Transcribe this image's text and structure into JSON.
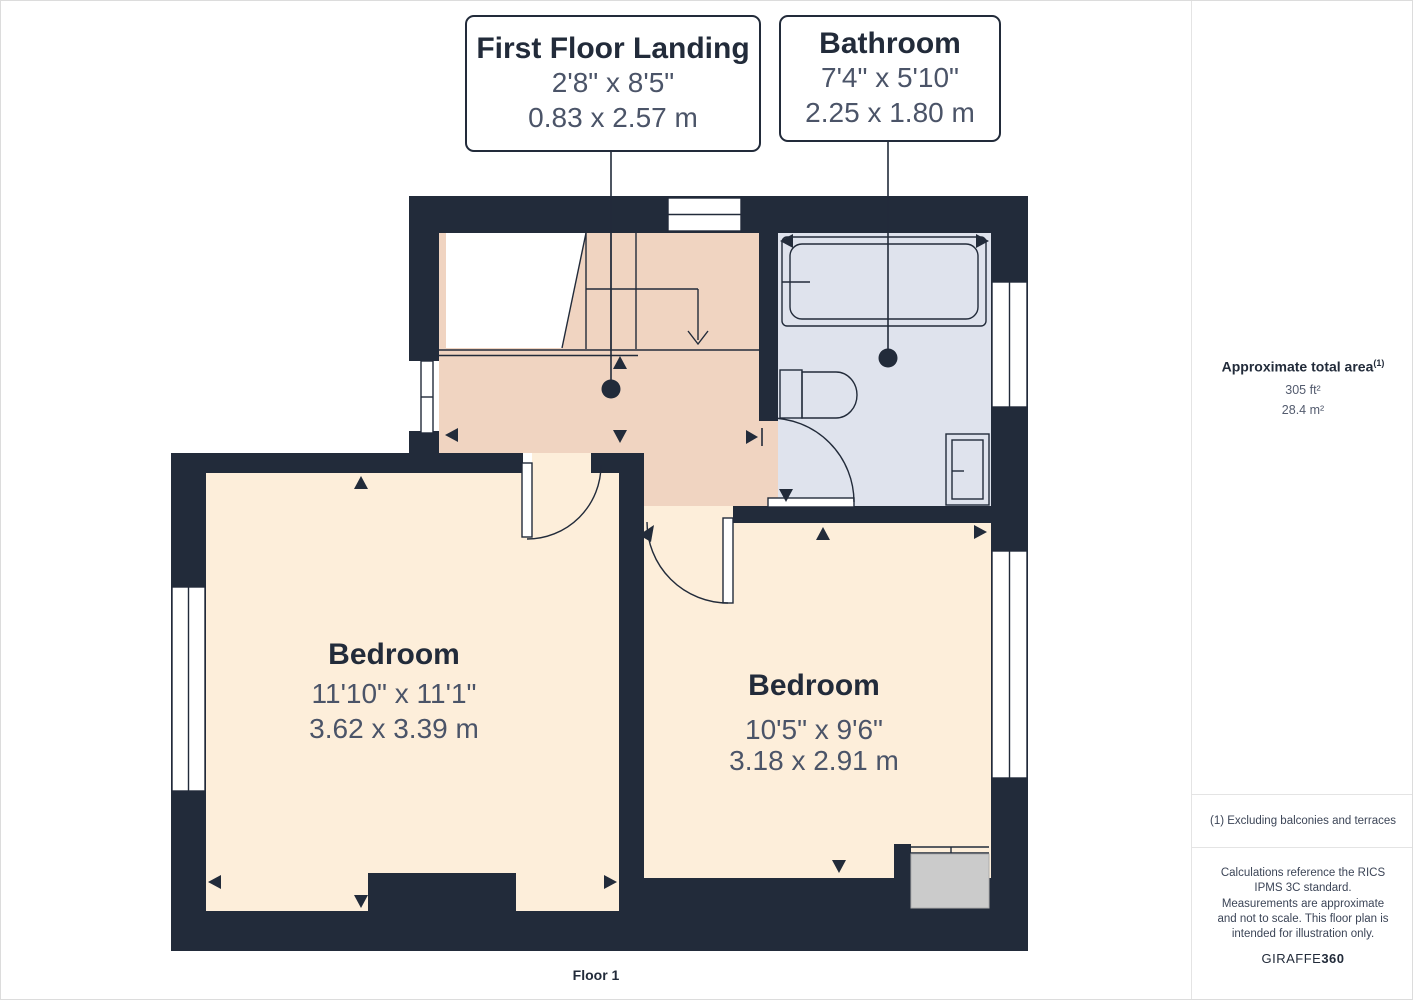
{
  "plan": {
    "floor_label": "Floor 1",
    "callouts": [
      {
        "title": "First Floor Landing",
        "imperial": "2'8\" x 8'5\"",
        "metric": "0.83 x 2.57 m"
      },
      {
        "title": "Bathroom",
        "imperial": "7'4\" x 5'10\"",
        "metric": "2.25 x 1.80 m"
      }
    ],
    "rooms": [
      {
        "name": "Bedroom",
        "imperial": "11'10\" x 11'1\"",
        "metric": "3.62 x 3.39 m"
      },
      {
        "name": "Bedroom",
        "imperial": "10'5\" x 9'6\"",
        "metric": "3.18 x 2.91 m"
      }
    ]
  },
  "sidebar": {
    "area_title": "Approximate total area",
    "area_sup": "(1)",
    "area_ft": "305 ft²",
    "area_m": "28.4 m²",
    "footnote": "(1) Excluding balconies and terraces",
    "disclaimer": "Calculations reference the RICS IPMS 3C standard. Measurements are approximate and not to scale. This floor plan is intended for illustration only.",
    "brand_prefix": "GIRAFFE",
    "brand_suffix": "360"
  },
  "colors": {
    "wall": "#222b3a",
    "landing_floor": "#f0d4c1",
    "bedroom_floor": "#fdeeda",
    "bathroom_floor": "#dfe3ed",
    "closet": "#cbcbcb",
    "dims_text": "#4b5468",
    "muted_text": "#3c4557"
  }
}
